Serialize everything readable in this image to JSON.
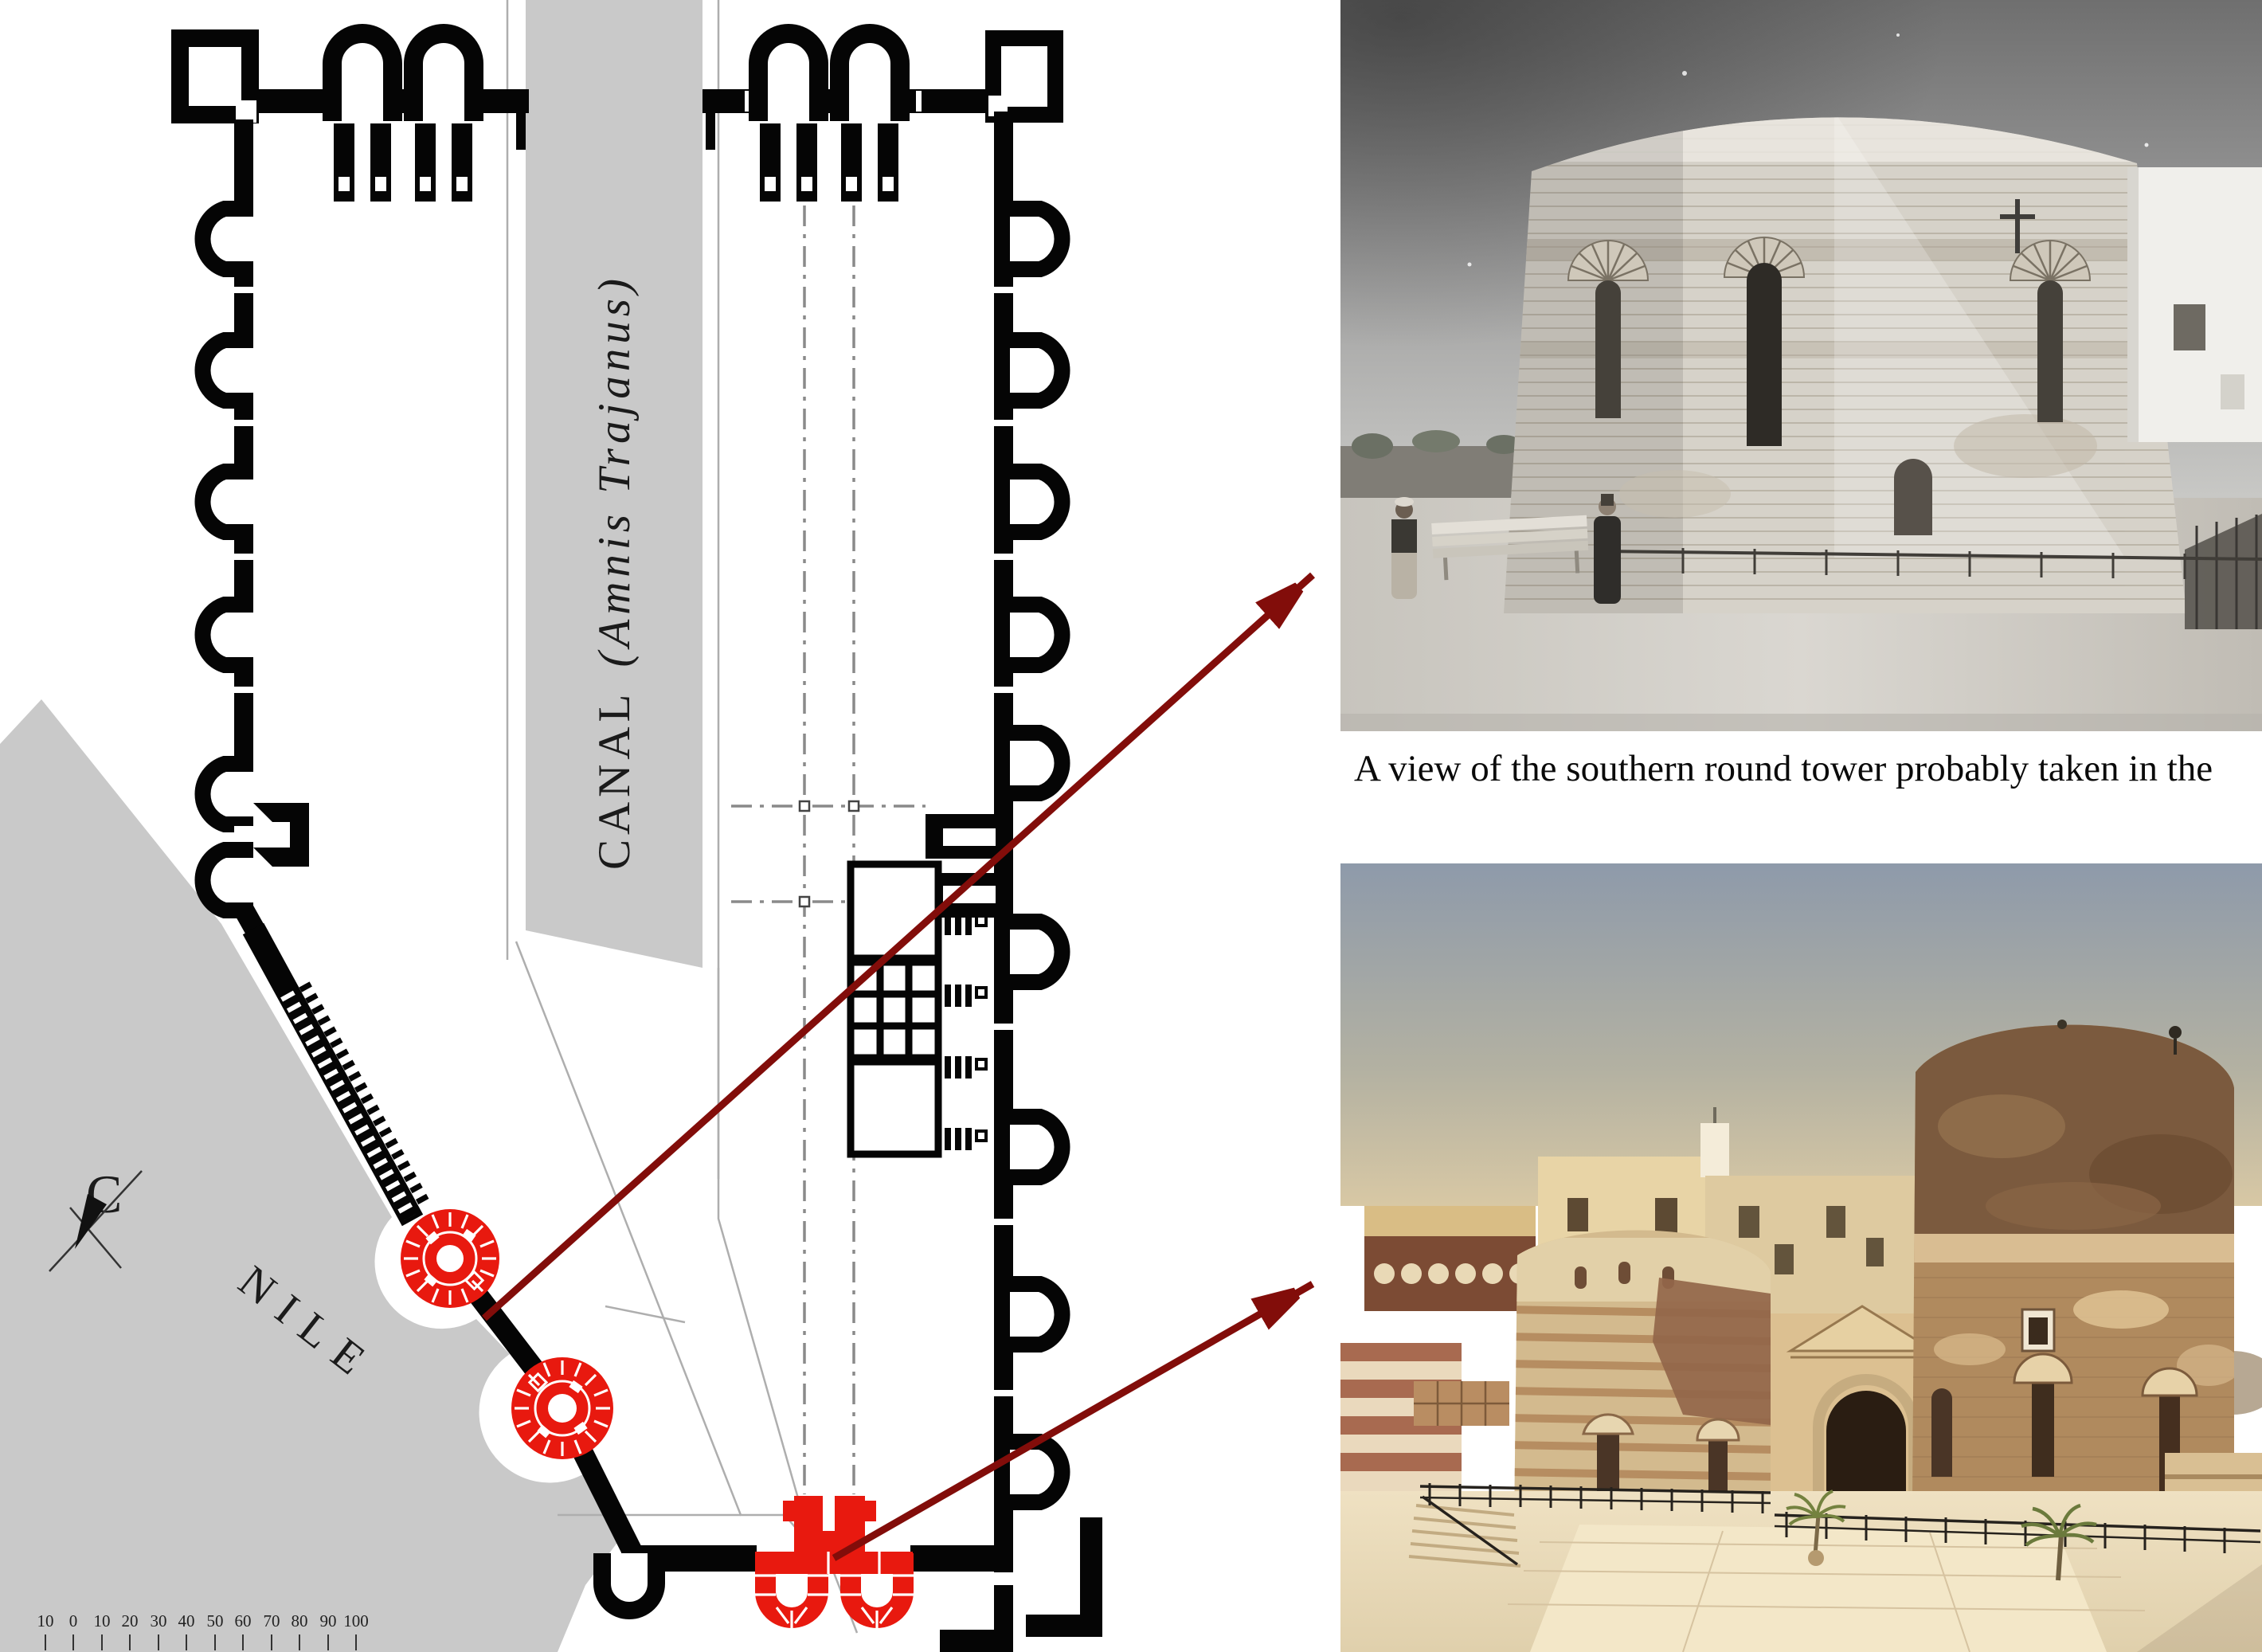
{
  "plan": {
    "canal_label": {
      "name": "CANAL ",
      "latin": "(Amnis Trajanus)"
    },
    "river_label": "NILE",
    "compass_label": "C",
    "scale_bar": {
      "values": [
        "10",
        "0",
        "10",
        "20",
        "30",
        "40",
        "50",
        "60",
        "70",
        "80",
        "90",
        "100"
      ]
    },
    "colors": {
      "wall_black": "#050505",
      "water_gray": "#c9c9c9",
      "highlight_red": "#e8190f",
      "arrow_red": "#820d0a",
      "caption_ink": "#0a0a0a"
    }
  },
  "caption": {
    "text": "A view of the southern round tower probably taken in the"
  }
}
